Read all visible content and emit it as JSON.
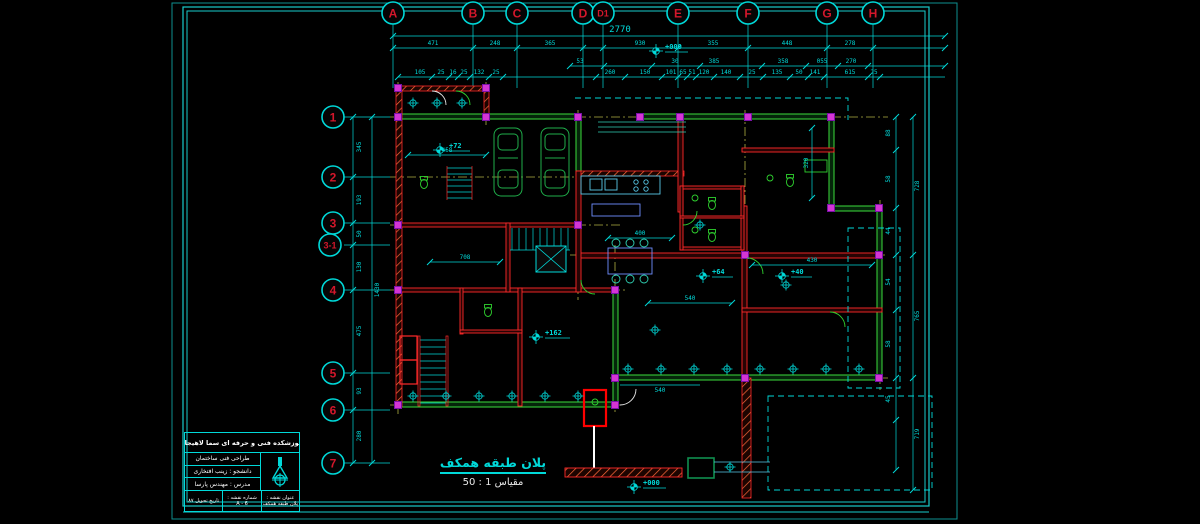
{
  "colors": {
    "cyan": "#00d9d9",
    "cyan_dim": "#0e8f8f",
    "red": "#ff2a2a",
    "red2": "#d4172b",
    "green": "#3cdc3c",
    "car_green": "#1fae4a",
    "yellow": "#d8d84a",
    "magenta": "#d435d4",
    "blue": "#6f8fff",
    "white": "#ffffff",
    "hatch": "#ff6a3a"
  },
  "grid": {
    "top": [
      "A",
      "B",
      "C",
      "D",
      "D1",
      "E",
      "F",
      "G",
      "H"
    ],
    "left": [
      "1",
      "2",
      "3",
      "3-1",
      "4",
      "5",
      "6",
      "7"
    ]
  },
  "dims": {
    "overall_width": "2770",
    "top_axis": [
      "471",
      "248",
      "365",
      "930",
      "355",
      "448",
      "278"
    ],
    "top_detail": [
      "53",
      "30",
      "385",
      "358",
      "055",
      "270"
    ],
    "top_fine": [
      "105",
      "25",
      "16",
      "25",
      "132",
      "25",
      "260",
      "150",
      "101",
      "65",
      "51",
      "120",
      "140",
      "25",
      "135",
      "50",
      "141",
      "615",
      "25"
    ],
    "left_axis": [
      "345",
      "193",
      "50",
      "130",
      "475",
      "93",
      "280"
    ],
    "left_total": "1430",
    "right_axis": [
      "728",
      "765",
      "719"
    ],
    "right_detail": [
      "88",
      "58",
      "44",
      "54",
      "58",
      "45"
    ],
    "interior": {
      "garage": "458",
      "hall": "400",
      "bed": "430",
      "lounge": "540",
      "side": "320",
      "porch_step": "708",
      "yard": "540"
    }
  },
  "levels": {
    "porch": "+72",
    "patio": "+64",
    "terrace": "+40",
    "yard": "+162",
    "entry": "+000",
    "top": "+000"
  },
  "plan_title": {
    "title": "پلان طبقه همکف",
    "scale": "مقیاس 1 : 50"
  },
  "title_block": {
    "school": "آموزشکده فنی و حرفه ای سما لاهیجان",
    "course": "طراحی فنی ساختمان",
    "student": "دانشجو : زینب افتخاری",
    "instructor": "مدرس : مهندس پارسا",
    "date_label": "تاریخ تحویل ۸۷",
    "sheet_label": "شماره نقشه :",
    "sheet_no": "A - 6",
    "name_label": "عنوان نقشه :",
    "name_value": "پلان طبقه همکف"
  }
}
